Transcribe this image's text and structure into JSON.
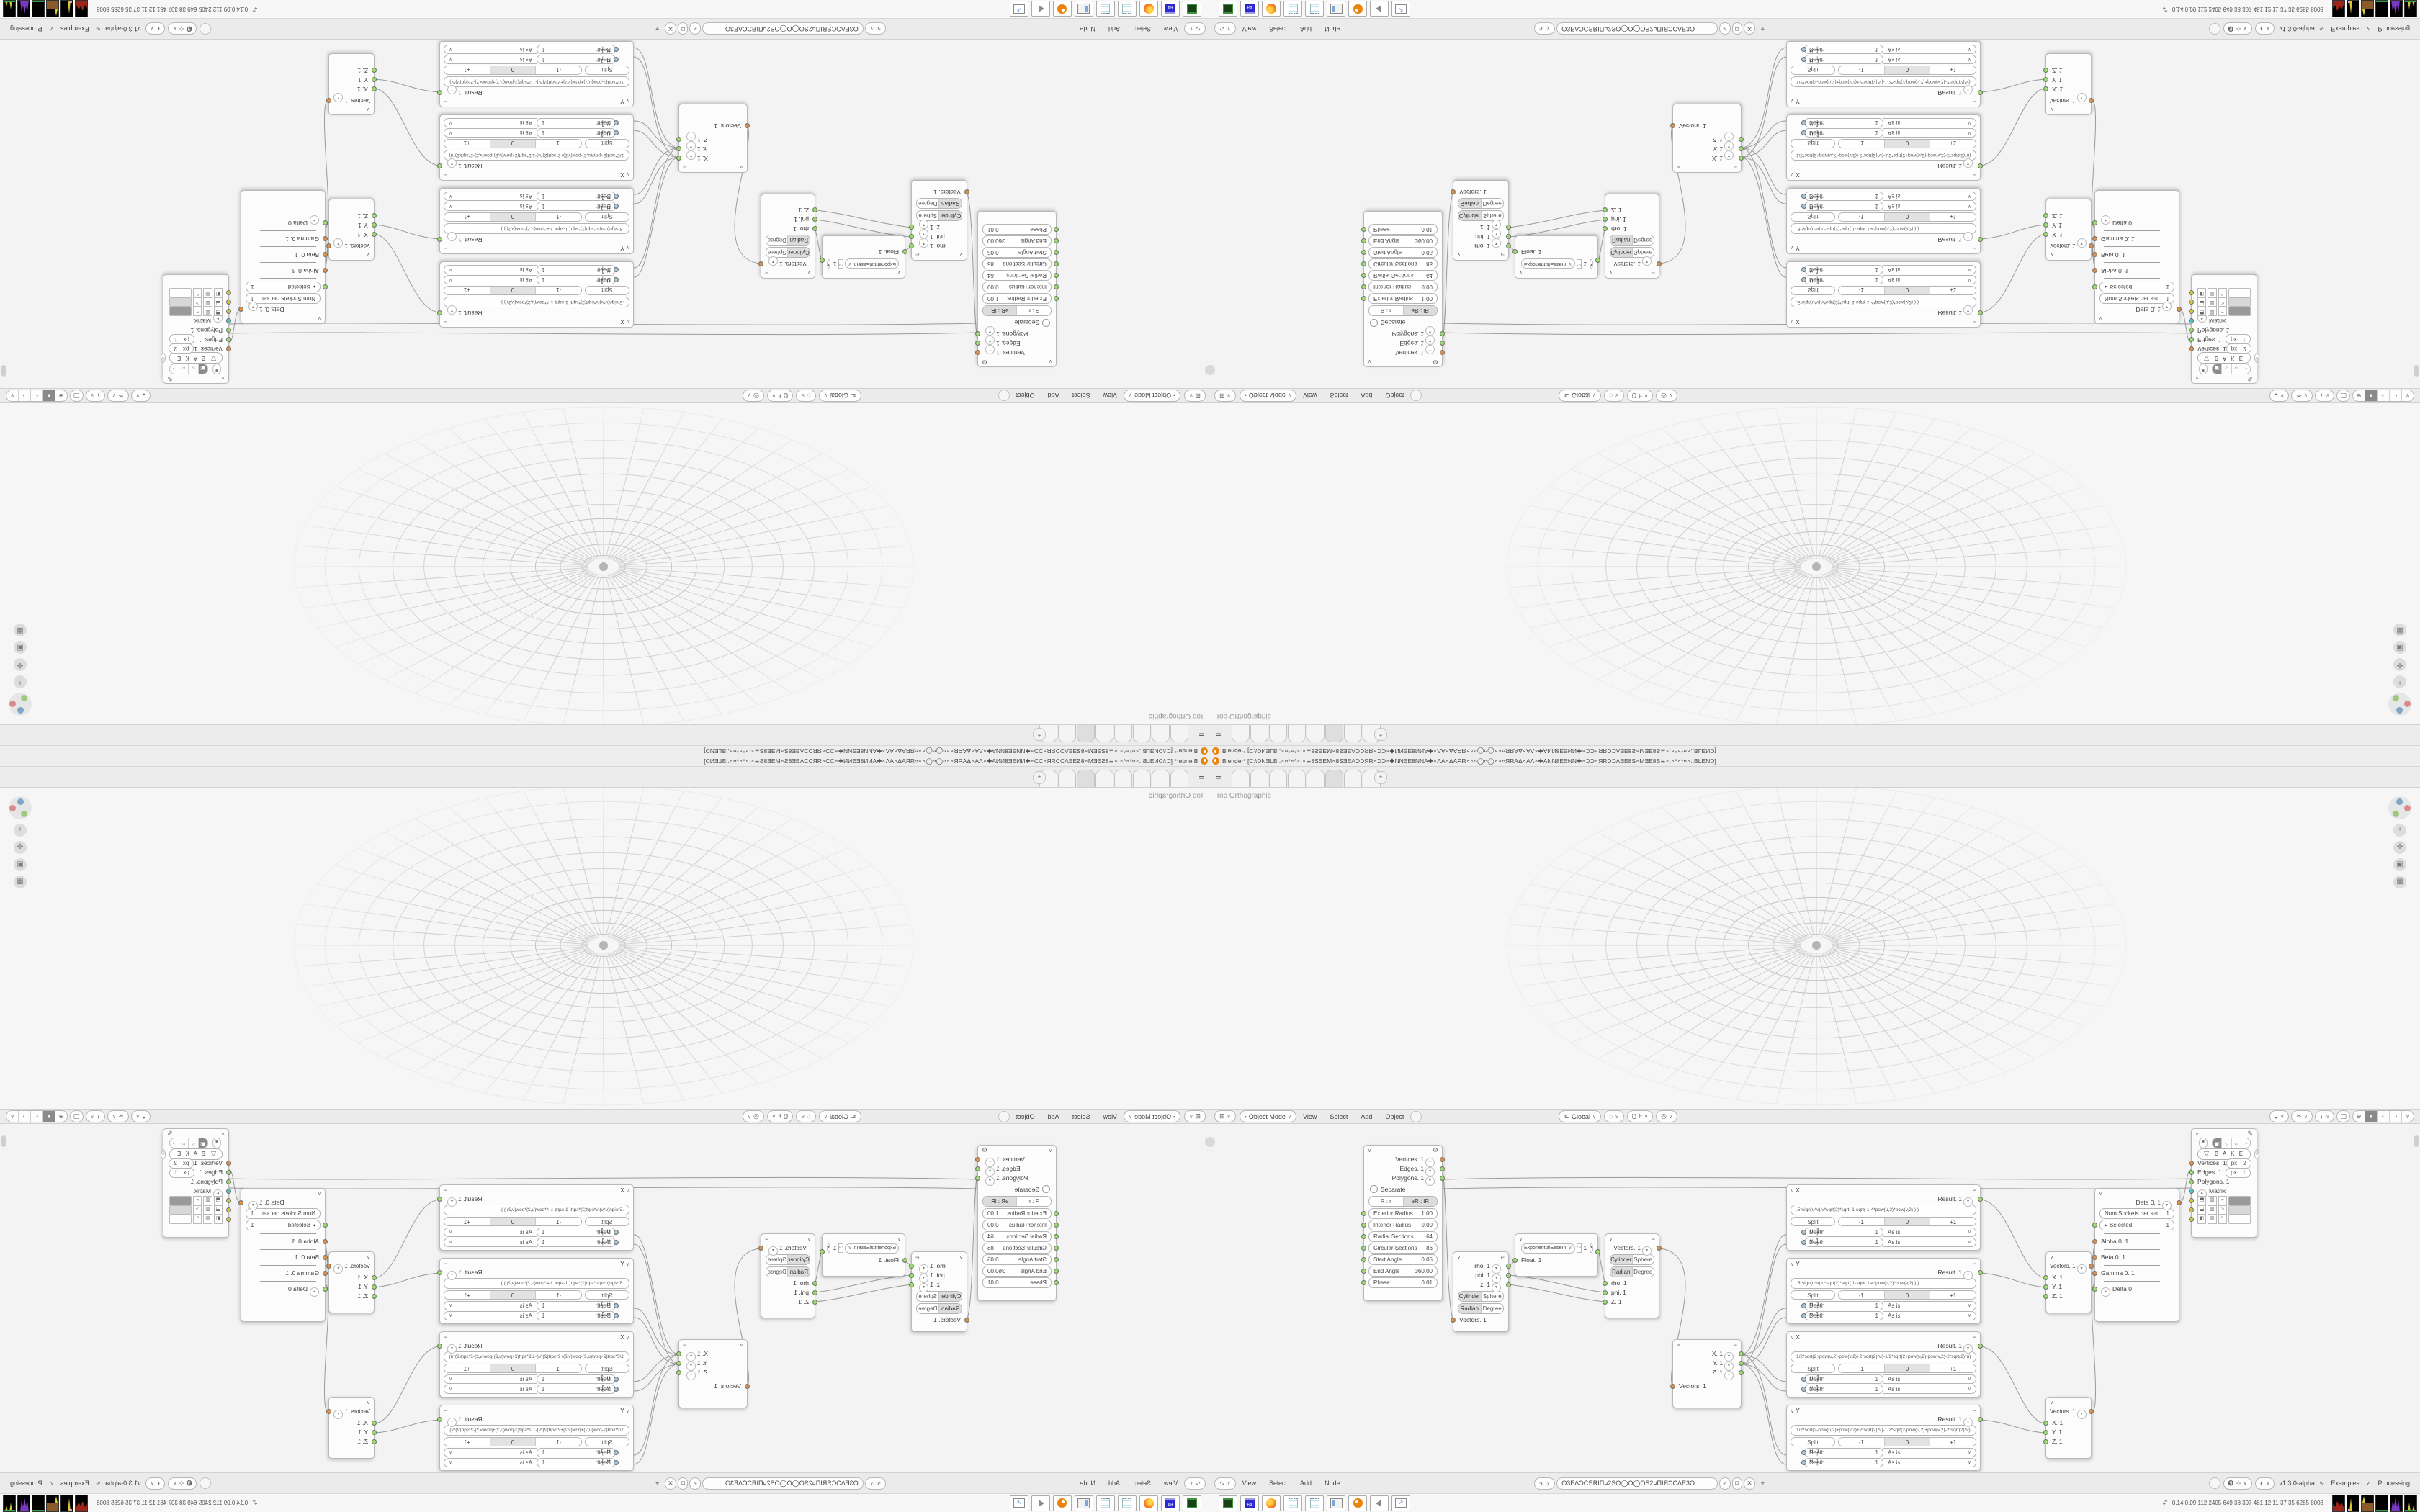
{
  "colors": {
    "blender_orange": "#e8830c",
    "socket_orange": "#dd9046",
    "socket_green": "#9ade69",
    "socket_cyan": "#49c8c8",
    "socket_yellow": "#d8c938",
    "panel_grey": "#ebebeb"
  },
  "tile": {
    "titlebar": {
      "title": "Blender* [C:\\DNƎLB..∘¤*∘*∘:∘≅8SƎEM∘8SƎEΛƆƆЯR∘ƆƆ∘✚NNƎE8NNA✚∘ΛA∘ΔAЯR∘∘¤◯¤◯∘∘¤ЯRAΔ∘AΛ∘✚ANN8EƎNN✚∘ƆƆ∘ЯRƆƆΛƎE8S∘MƎE8S≅∘:∘*∘*¤∘..BLEND]"
    },
    "viewport": {
      "view_label": "Top Orthographic",
      "mode": "Object Mode",
      "menus": [
        "View",
        "Select",
        "Add",
        "Object"
      ],
      "orientation": "Global"
    },
    "node_header": {
      "menus": [
        "View",
        "Select",
        "Add",
        "Node"
      ],
      "tree_name": "O3EΛƆCЯRIΠ¤2SO◯O◯OS2¤ΠIЯƆCΛE3O",
      "version": "v1.3.0-alpha",
      "examples_label": "Examples",
      "processing_label": "Processing"
    },
    "nodes": {
      "torus": {
        "outputs": [
          "Vertices. 1",
          "Edges. 1",
          "Polygons. 1"
        ],
        "separate_label": "Separate",
        "mode_a": "R : r",
        "mode_b": "eR : iR",
        "fields": [
          [
            "Exterior Radius",
            "1.00"
          ],
          [
            "Interior Radius",
            "0.00"
          ],
          [
            "Radial Sections",
            "64"
          ],
          [
            "Circular Sections",
            "86"
          ],
          [
            "Start Angle",
            "0.05"
          ],
          [
            "End Angle",
            "360.00"
          ],
          [
            "Phase",
            "0.01"
          ]
        ]
      },
      "polar_out": {
        "outputs": [
          "rho. 1",
          "phi. 1",
          "z. 1"
        ],
        "seg1": [
          "Cylinder",
          "Sphere"
        ],
        "seg2": [
          "Radian",
          "Degree"
        ],
        "input": "Vectors. 1"
      },
      "easing": {
        "mode": "ExponentialEaseIn",
        "value": "1",
        "input": "Float. 1"
      },
      "polar_in": {
        "output": "Vectors. 1",
        "seg1": [
          "Cylinder",
          "Sphere"
        ],
        "seg2": [
          "Radian",
          "Degree"
        ],
        "inputs": [
          "rho. 1",
          "phi. 1",
          "Z. 1"
        ]
      },
      "vector_out": {
        "outputs": [
          "X. 1",
          "Y. 1",
          "Z. 1"
        ],
        "input": "Vectors. 1"
      },
      "formula_common": {
        "result": "Result. 1",
        "split": "Split",
        "minus": "-1",
        "zero": "0",
        "plus": "+1",
        "u": "u. 1",
        "v": "v. 1",
        "depth_label": "Depth",
        "depth_value": "1",
        "wrap": "As is"
      },
      "formula_nodes": [
        {
          "name": "X",
          "formula": ".5*sign(u*v)/v*sqrt(2)*sqrt(   1-sqrt(   1-4*pow(u,2)*pow(v,2)   )   )"
        },
        {
          "name": "Y",
          "formula": ".5*sign(u*v)/u*sqrt(2)*sqrt(   1-sqrt(   1-4*pow(u,2)*pow(v,2)   )   )"
        },
        {
          "name": "X",
          "formula": "1/2*sqrt(2+pow(u,2)-pow(v,2)+2*sqrt(2)*u)-1/2*sqrt(2+pow(u,2)-pow(v,2)-2*sqrt(2)*u)"
        },
        {
          "name": "Y",
          "formula": "1/2*sqrt(2-pow(u,2)+pow(v,2)+2*sqrt(2)*v)-1/2*sqrt(2-pow(u,2)+pow(v,2)-2*sqrt(2)*v)"
        }
      ],
      "vector_in": {
        "output": "Vectors. 1",
        "inputs": [
          "X. 1",
          "Y. 1",
          "Z. 1"
        ]
      },
      "data_node": {
        "output": "Data 0. 1",
        "num_sockets_label": "Num Sockets per set",
        "num_sockets_value": "1",
        "selected_label": "Selected",
        "selected_value": "1",
        "alpha": "Alpha 0. 1",
        "beta": "Beta 0. 1",
        "gamma": "Gamma 0. 1",
        "delta": "Delta 0"
      },
      "viewer": {
        "bake": "B A K E",
        "vertices": "Vertices. 1",
        "vertices_px": "2",
        "edges": "Edges. 1",
        "edges_px": "1",
        "polygons": "Polygons. 1",
        "matrix": "Matrix",
        "px": "px"
      }
    },
    "taskbar": {
      "stats": "0.14 0.09 112 2405 649  38  397  481  12  11  37  35 6285 8008",
      "icons": [
        "emulator",
        "floppy-64",
        "firefox",
        "notepad",
        "notepad",
        "app-window",
        "blender",
        "speaker",
        "window-arrow"
      ]
    }
  }
}
